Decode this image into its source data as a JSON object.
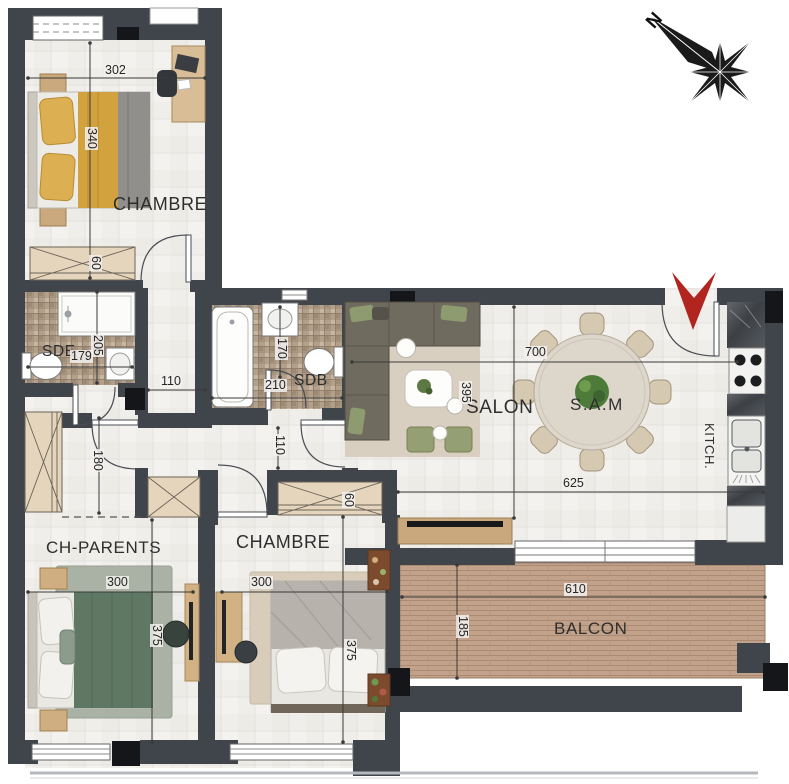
{
  "compass": {
    "north_label": "N"
  },
  "rooms": {
    "chambre1": {
      "label": "CHAMBRE"
    },
    "sde": {
      "label": "SDE"
    },
    "sdb": {
      "label": "SDB"
    },
    "salon": {
      "label": "SALON"
    },
    "sam": {
      "label": "S.A.M"
    },
    "kitchen": {
      "label": "KITCH."
    },
    "ch_parents": {
      "label": "CH-PARENTS"
    },
    "chambre2": {
      "label": "CHAMBRE"
    },
    "balcon": {
      "label": "BALCON"
    }
  },
  "dimensions_cm": {
    "chambre1_width": "302",
    "chambre1_depth": "340",
    "closet_chambre1": "60",
    "sde_depth": "205",
    "sde_width": "179",
    "hall_width": "110",
    "sdb_depth": "170",
    "sdb_width": "210",
    "corridor_width": "110",
    "hall_depth": "180",
    "living_width": "700",
    "living_depth": "395",
    "dining_width": "625",
    "ch_parents_width": "300",
    "ch_parents_depth": "375",
    "chambre2_width": "300",
    "chambre2_depth": "375",
    "closet_chambre2": "60",
    "balcon_width": "610",
    "balcon_depth": "185"
  },
  "colors": {
    "wall": "#40444b",
    "pillar": "#15161a",
    "entry_arrow_red": "#b1241f",
    "mosaic_tile": "#b3a08b",
    "balcony_deck": "#c2a28b",
    "sofa": "#6f6b5e",
    "bed1_duvet_gold": "#d2a23e",
    "bed_parents_green": "#5f7864",
    "cushion_green": "#8e9b70"
  }
}
